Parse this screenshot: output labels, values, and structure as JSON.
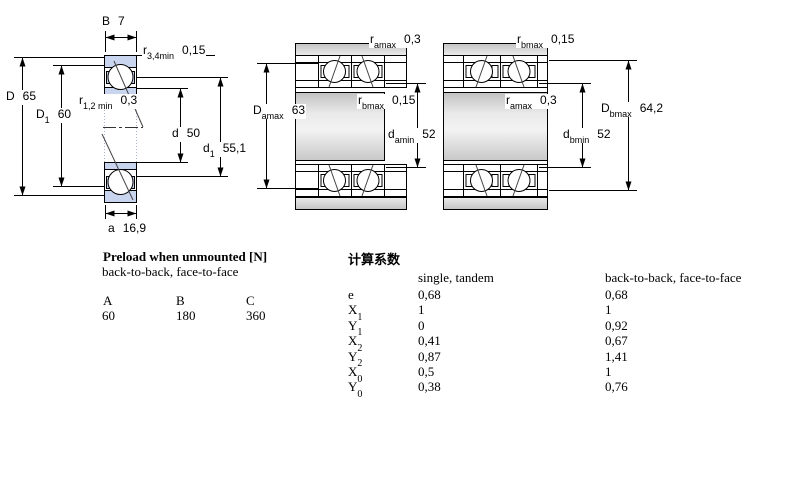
{
  "colors": {
    "ring_blue": "#c9d5ee",
    "line_black": "#000000",
    "metal_dark": "#c2c2c2",
    "metal_light": "#f2f2f2"
  },
  "figure_left": {
    "labels": {
      "b": {
        "sym": "B",
        "sub": "",
        "val": "7"
      },
      "r34": {
        "sym": "r",
        "sub": "3,4min",
        "val": "0,15"
      },
      "D": {
        "sym": "D",
        "sub": "",
        "val": "65"
      },
      "D1": {
        "sym": "D",
        "sub": "1",
        "val": "60"
      },
      "r12": {
        "sym": "r",
        "sub": "1,2 min",
        "val": "0,3"
      },
      "d": {
        "sym": "d",
        "sub": "",
        "val": "50"
      },
      "d1": {
        "sym": "d",
        "sub": "1",
        "val": "55,1"
      },
      "a": {
        "sym": "a",
        "sub": "",
        "val": "16,9"
      }
    }
  },
  "figure_middle": {
    "labels": {
      "ramax": {
        "sym": "r",
        "sub": "amax",
        "val": "0,3"
      },
      "rbmax": {
        "sym": "r",
        "sub": "bmax",
        "val": "0,15"
      },
      "Damax": {
        "sym": "D",
        "sub": "amax",
        "val": "63"
      },
      "damin": {
        "sym": "d",
        "sub": "amin",
        "val": "52"
      }
    }
  },
  "figure_right": {
    "labels": {
      "rbmax": {
        "sym": "r",
        "sub": "bmax",
        "val": "0,15"
      },
      "ramax": {
        "sym": "r",
        "sub": "amax",
        "val": "0,3"
      },
      "Dbmax": {
        "sym": "D",
        "sub": "bmax",
        "val": "64,2"
      },
      "dbmin": {
        "sym": "d",
        "sub": "bmin",
        "val": "52"
      }
    }
  },
  "preload": {
    "title": "Preload when unmounted [N]",
    "subtitle": "back-to-back, face-to-face",
    "columns": [
      "A",
      "B",
      "C"
    ],
    "values": [
      "60",
      "180",
      "360"
    ]
  },
  "factors": {
    "title": "计算系数",
    "col_single": "single, tandem",
    "col_pair": "back-to-back, face-to-face",
    "rows": [
      {
        "sym": "e",
        "sub": "",
        "single": "0,68",
        "pair": "0,68"
      },
      {
        "sym": "X",
        "sub": "1",
        "single": "1",
        "pair": "1"
      },
      {
        "sym": "Y",
        "sub": "1",
        "single": "0",
        "pair": "0,92"
      },
      {
        "sym": "X",
        "sub": "2",
        "single": "0,41",
        "pair": "0,67"
      },
      {
        "sym": "Y",
        "sub": "2",
        "single": "0,87",
        "pair": "1,41"
      },
      {
        "sym": "X",
        "sub": "0",
        "single": "0,5",
        "pair": "1"
      },
      {
        "sym": "Y",
        "sub": "0",
        "single": "0,38",
        "pair": "0,76"
      }
    ]
  }
}
